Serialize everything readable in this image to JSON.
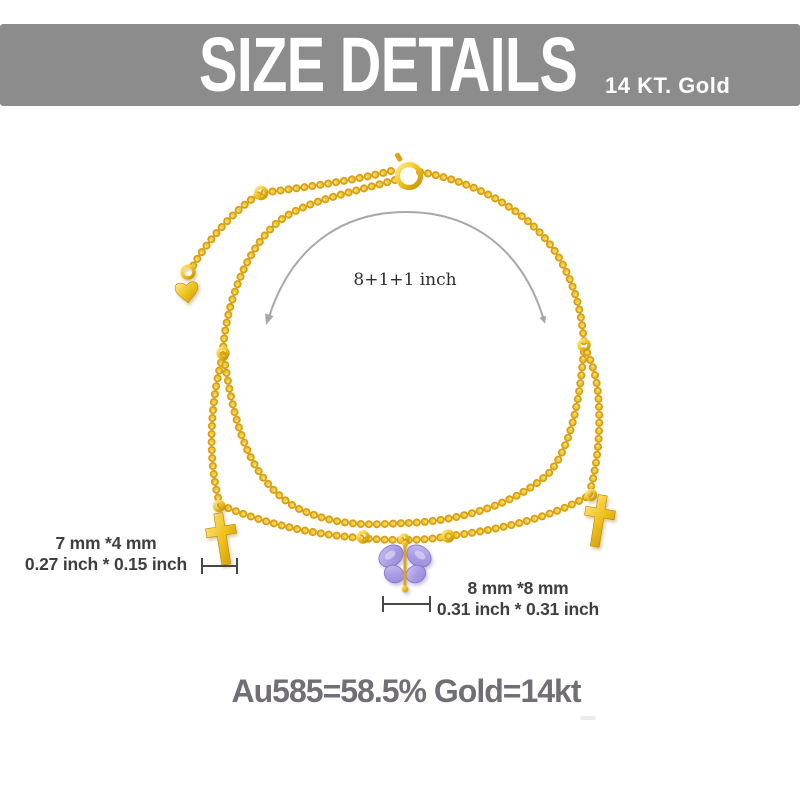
{
  "header": {
    "title": "SIZE DETAILS",
    "subtitle": "14 KT. Gold"
  },
  "annotations": {
    "length_label": "8+1+1 inch",
    "cross_charm": {
      "size_mm": "7 mm *4 mm",
      "size_inch": "0.27 inch * 0.15 inch"
    },
    "butterfly_charm": {
      "size_mm": "8 mm *8 mm",
      "size_inch": "0.31 inch * 0.31 inch"
    },
    "purity": "Au585=58.5% Gold=14kt"
  },
  "product": {
    "item": "double-layer chain anklet",
    "charms": [
      "heart tag",
      "cross",
      "crystal butterfly",
      "cross"
    ],
    "clasp": "spring ring"
  },
  "colors": {
    "banner_bg": "#8c8c8c",
    "banner_text": "#ffffff",
    "gold_dark": "#d79f12",
    "gold_mid": "#f3c93e",
    "gold_light": "#ffeca0",
    "guide_line": "#a8a8a8",
    "bracket": "#474747",
    "label_text": "#3f3f3f",
    "serif_label_text": "#2e2e2e",
    "purity_text": "#716e75",
    "butterfly_light": "#cdc2f0",
    "butterfly_dark": "#9b8bdb"
  }
}
